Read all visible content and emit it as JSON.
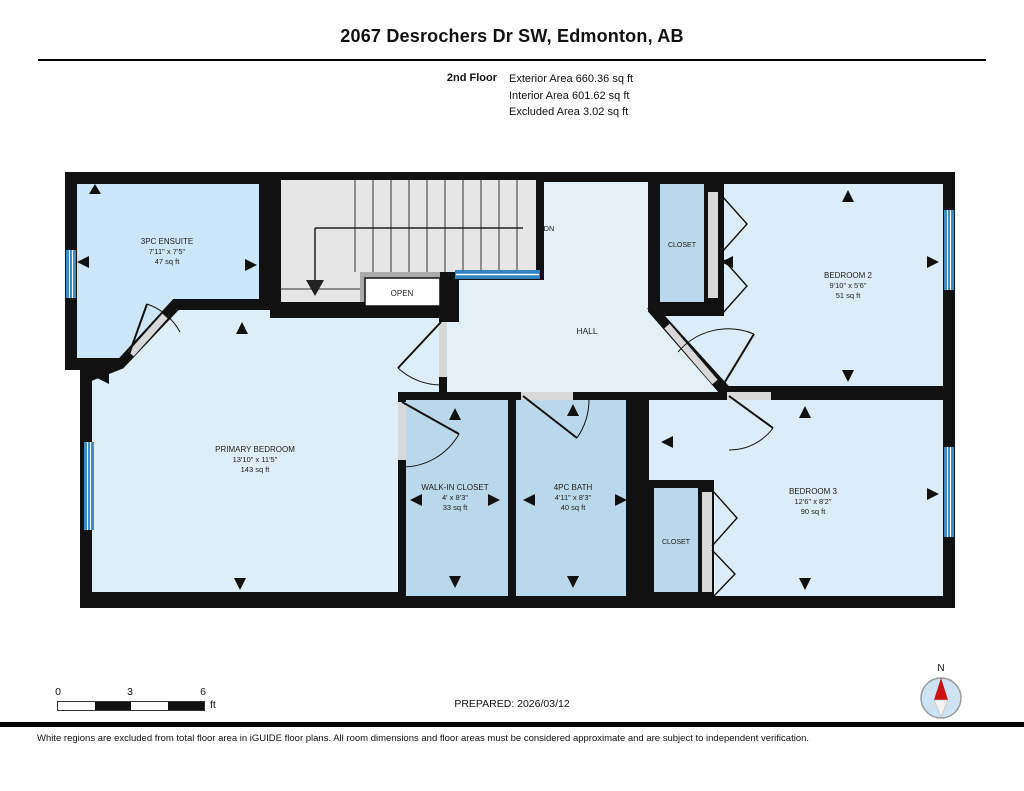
{
  "header": {
    "title": "2067 Desrochers Dr SW, Edmonton, AB",
    "floor_label": "2nd Floor",
    "area_lines": [
      "Exterior Area 660.36 sq ft",
      "Interior Area 601.62 sq ft",
      "Excluded Area 3.02 sq ft"
    ]
  },
  "rooms": {
    "ensuite": {
      "name": "3PC ENSUITE",
      "dims": "7'11\" x 7'5\"",
      "area": "47 sq ft"
    },
    "primary_bedroom": {
      "name": "PRIMARY BEDROOM",
      "dims": "13'10\" x 11'5\"",
      "area": "143 sq ft"
    },
    "walk_in_closet": {
      "name": "WALK-IN CLOSET",
      "dims": "4' x 8'3\"",
      "area": "33 sq ft"
    },
    "bath": {
      "name": "4PC BATH",
      "dims": "4'11\" x 8'3\"",
      "area": "40 sq ft"
    },
    "bedroom2": {
      "name": "BEDROOM 2",
      "dims": "9'10\" x 5'6\"",
      "area": "51 sq ft"
    },
    "bedroom3": {
      "name": "BEDROOM 3",
      "dims": "12'6\" x 8'2\"",
      "area": "90 sq ft"
    },
    "closet_top": {
      "name": "CLOSET"
    },
    "closet_bottom": {
      "name": "CLOSET"
    },
    "hall": {
      "name": "HALL"
    },
    "stairs": {
      "open_label": "OPEN",
      "down_label": "DN"
    }
  },
  "scale_bar": {
    "tick_labels": [
      "0",
      "3",
      "6"
    ],
    "unit": "ft"
  },
  "compass": {
    "north_label": "N"
  },
  "footer": {
    "prepared": "PREPARED: 2026/03/12",
    "disclaimer": "White regions are excluded from total floor area in iGUIDE floor plans. All room dimensions and floor areas must be considered approximate and are subject to independent verification."
  },
  "colors": {
    "wall": "#111111",
    "bedroom_fill": "#dcedf9",
    "ensuite_fill": "#cbe7f9",
    "hall_fill": "#e2f1f6",
    "wet_room_fill": "#b9d8ec",
    "stairs_fill": "#e6e6e6",
    "window_blue": "#3d8ec6",
    "railing_blue": "#2e86c1"
  }
}
